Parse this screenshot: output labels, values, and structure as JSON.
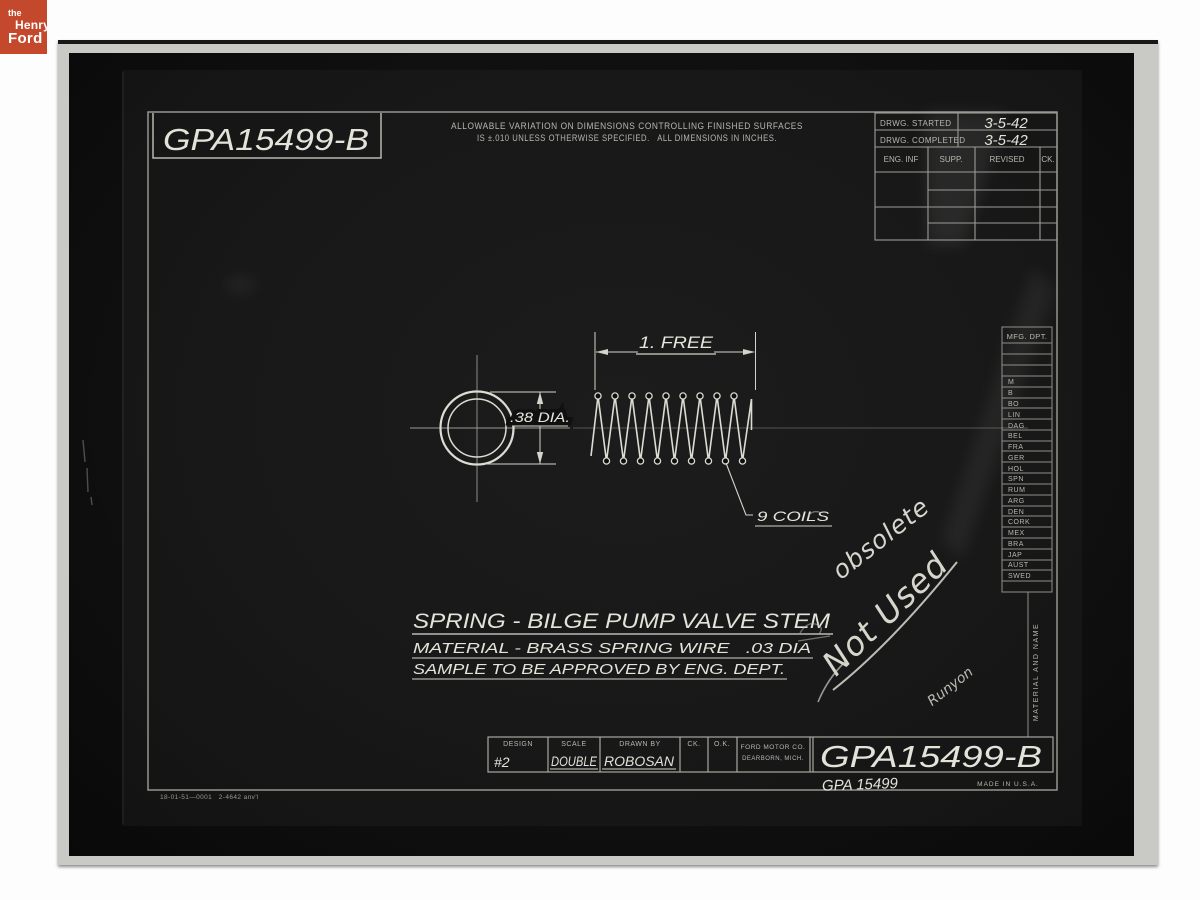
{
  "logo": {
    "the": "the",
    "henry": "Henry",
    "ford": "Ford"
  },
  "top": {
    "drawing_number": "GPA15499-B",
    "note_line1": "ALLOWABLE VARIATION ON DIMENSIONS CONTROLLING FINISHED SURFACES",
    "note_line2": "IS ±.010 UNLESS OTHERWISE SPECIFIED.   ALL DIMENSIONS IN INCHES."
  },
  "rev_table": {
    "started_label": "DRWG. STARTED",
    "started_value": "3-5-42",
    "completed_label": "DRWG. COMPLETED",
    "completed_value": "3-5-42",
    "col1": "ENG. INF",
    "col2": "SUPP.",
    "col3": "REVISED",
    "col4": "CK."
  },
  "mfg": {
    "header": "MFG. DPT.",
    "entries": [
      "M",
      "B",
      "BO",
      "LIN",
      "DAG",
      "BEL",
      "FRA",
      "GER",
      "HOL",
      "SPN",
      "RUM",
      "ARG",
      "DEN",
      "CORK",
      "MEX",
      "BRA",
      "JAP",
      "AUST",
      "SWED"
    ]
  },
  "drawing": {
    "dim_free": "1. FREE",
    "dim_dia": ".38 DIA.",
    "coils": "9 COILS"
  },
  "title": {
    "line1": "SPRING - BILGE PUMP VALVE STEM",
    "line2": "MATERIAL - BRASS SPRING WIRE   .03 DIA",
    "line3": "SAMPLE TO BE APPROVED BY ENG. DEPT."
  },
  "annotations": {
    "obsolete": "obsolete",
    "not_used": "Not Used",
    "signature": "Runyon"
  },
  "title_block": {
    "design_label": "DESIGN",
    "design_value": "#2",
    "scale_label": "SCALE",
    "scale_value": "DOUBLE",
    "drawn_label": "DRAWN BY",
    "drawn_value": "ROBOSAN",
    "ck_label": "CK.",
    "ok_label": "O.K.",
    "company1": "FORD MOTOR CO.",
    "company2": "DEARBORN, MICH.",
    "drawing_number": "GPA15499-B",
    "handwritten_number": "GPA 15499",
    "made_in": "MADE IN U.S.A."
  },
  "side_label": "MATERIAL AND NAME",
  "footer_code": "18-01-51—0001   2-4642 anv'l",
  "colors": {
    "logo_bg": "#c4492c",
    "line_bright": "#dcdcd3",
    "line_dim": "#9c9c94",
    "paper": "#c9c9c5"
  }
}
